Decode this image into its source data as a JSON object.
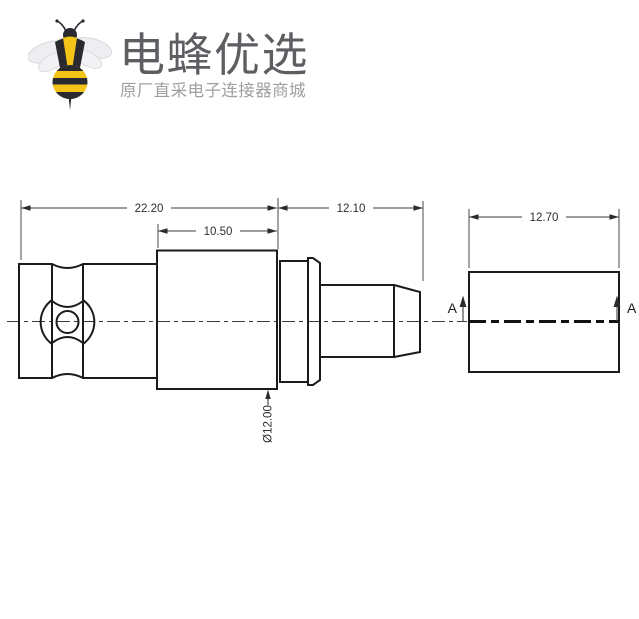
{
  "logo": {
    "brand": "电蜂优选",
    "tagline": "原厂直采电子连接器商城",
    "colors": {
      "bee_yellow": "#F3C317",
      "bee_black": "#2A2930",
      "wing_gray": "#EBEBEE",
      "brand_text": "#5D5E62",
      "tagline_text": "#9FA0A3"
    }
  },
  "drawing": {
    "dimensions": {
      "overall": "22.20",
      "body": "10.50",
      "rear": "12.10",
      "side_block": "12.70",
      "diameter": "Ø12.00"
    },
    "section_labels": {
      "left": "A",
      "right": "A"
    },
    "colors": {
      "outline": "#1B1B1B",
      "dimension_lines": "#3C3C3C"
    }
  }
}
